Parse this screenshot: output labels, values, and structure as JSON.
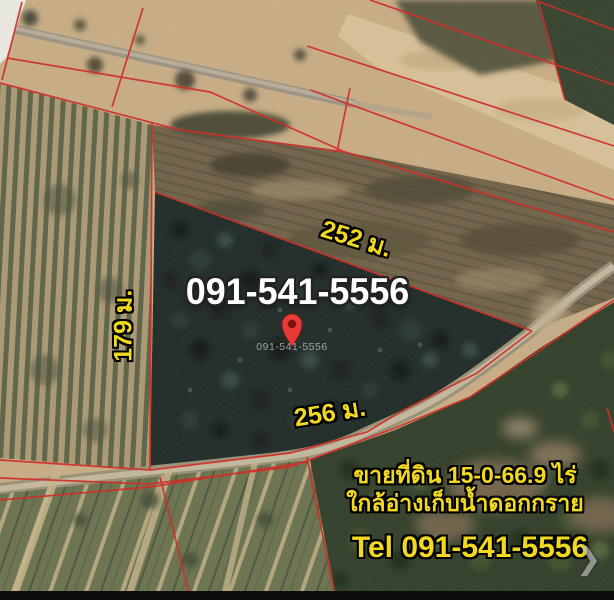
{
  "colors": {
    "boundary_red": "#d2261f",
    "label_yellow": "#f2d91e",
    "phone_white": "#ffffff",
    "pin_red": "#e63b36"
  },
  "map_overlay": {
    "phone_watermark_large": "091-541-5556",
    "phone_watermark_small": "091-541-5556",
    "measurements": {
      "top_edge": "252 ม.",
      "left_edge": "179 ม.",
      "bottom_edge": "256 ม."
    },
    "listing": {
      "area_line": "ขายที่ดิน 15-0-66.9 ไร่",
      "location_line": "ใกล้อ่างเก็บน้ำดอกกราย",
      "tel_line": "Tel 091-541-5556"
    },
    "next_arrow_glyph": "❯"
  }
}
